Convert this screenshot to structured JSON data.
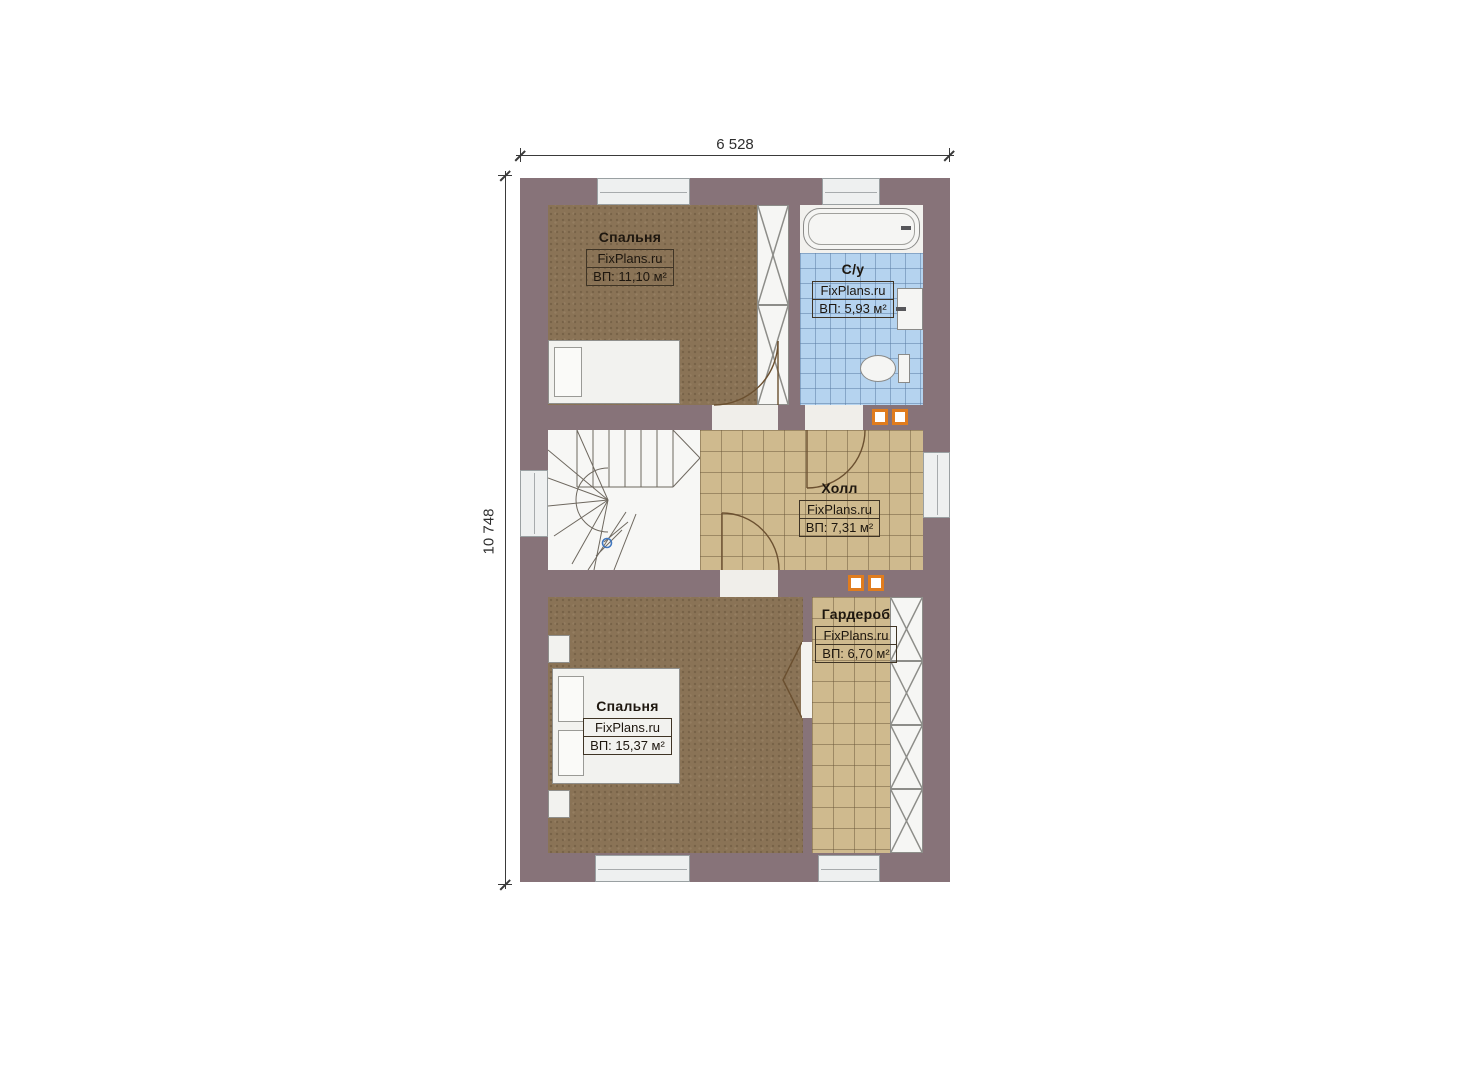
{
  "plan_type": "floor-plan",
  "dimensions": {
    "width_label": "6 528",
    "height_label": "10 748"
  },
  "rooms": {
    "bedroom_top": {
      "name": "Спальня",
      "brand": "FixPlans.ru",
      "area": "ВП: 11,10 м²"
    },
    "bathroom": {
      "name": "С/у",
      "brand": "FixPlans.ru",
      "area": "ВП: 5,93 м²"
    },
    "hall": {
      "name": "Холл",
      "brand": "FixPlans.ru",
      "area": "ВП: 7,31 м²"
    },
    "wardrobe": {
      "name": "Гардероб",
      "brand": "FixPlans.ru",
      "area": "ВП: 6,70 м²"
    },
    "bedroom_bottom": {
      "name": "Спальня",
      "brand": "FixPlans.ru",
      "area": "ВП: 15,37 м²"
    }
  },
  "colors": {
    "wall": "#877379",
    "floor_carpet": "#8a7356",
    "floor_tile_tan": "#cfba8e",
    "floor_tile_blue": "#b5d3ef",
    "vent_accent": "#e07c1e"
  }
}
